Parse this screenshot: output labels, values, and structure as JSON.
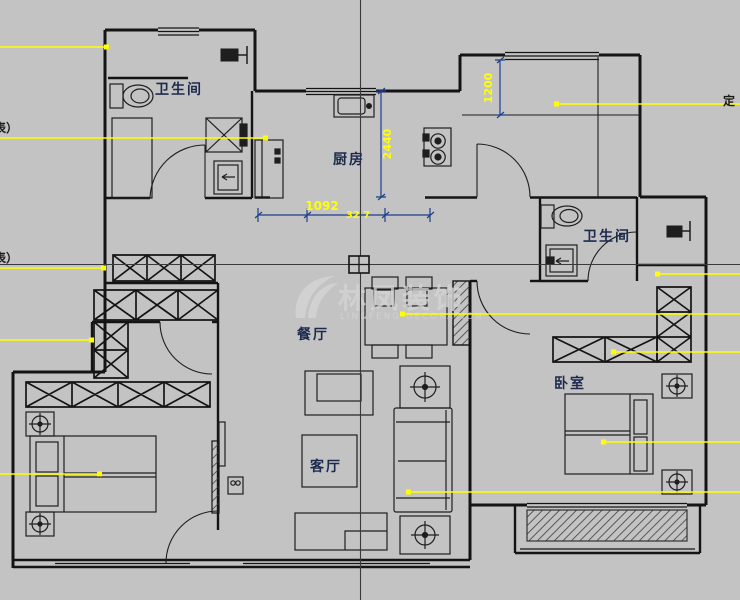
{
  "canvas": {
    "width": 740,
    "height": 600,
    "background": "#c3c3c3"
  },
  "colors": {
    "wall": "#141414",
    "furniture": "#1e1e1e",
    "leader_line": "#ffff00",
    "dimension_line": "#1d3e8c",
    "dimension_text": "#ffff00",
    "room_label": "#1b2a4d",
    "crosshair": "#3a3a3a",
    "watermark": "#d4d4d4"
  },
  "room_labels": {
    "bathroom_top_left": "卫生间",
    "kitchen": "厨房",
    "bathroom_right": "卫生间",
    "dining_room": "餐厅",
    "living_room": "客厅",
    "bedroom_right": "卧室"
  },
  "dimension_texts": {
    "upper_right_vertical": "1200",
    "kitchen_vertical": "2440",
    "kitchen_opening_horizontal": "1092",
    "kitchen_opening_secondary": "32 7"
  },
  "edge_texts": {
    "left_upper": "表）",
    "left_lower": "表）",
    "right": "定"
  },
  "watermark": {
    "brand": "林凤装饰",
    "subtitle": "LIN&FENG DECORATION"
  }
}
